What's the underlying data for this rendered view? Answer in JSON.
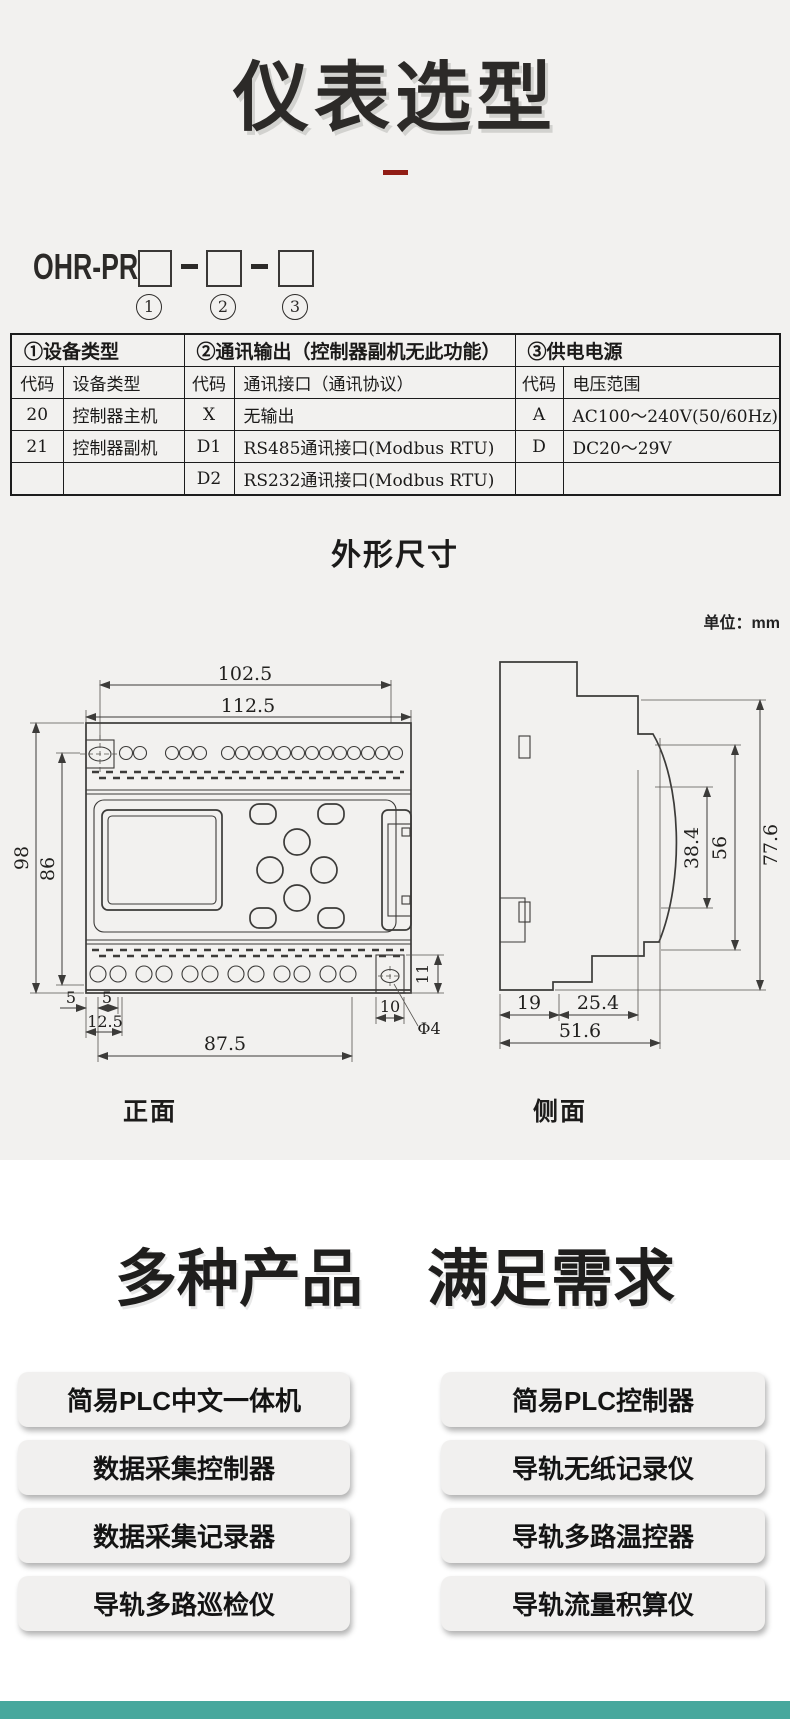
{
  "header": {
    "title": "仪表选型"
  },
  "model_code": {
    "prefix": "OHR-PR",
    "slot_labels": [
      "1",
      "2",
      "3"
    ]
  },
  "selection_table": {
    "section_headers": [
      "①设备类型",
      "②通讯输出（控制器副机无此功能）",
      "③供电电源"
    ],
    "column_headers": [
      "代码",
      "设备类型",
      "代码",
      "通讯接口（通讯协议）",
      "代码",
      "电压范围"
    ],
    "rows": [
      [
        "20",
        "控制器主机",
        "X",
        "无输出",
        "A",
        "AC100～240V(50/60Hz)"
      ],
      [
        "21",
        "控制器副机",
        "D1",
        "RS485通讯接口(Modbus RTU)",
        "D",
        "DC20～29V"
      ],
      [
        "",
        "",
        "D2",
        "RS232通讯接口(Modbus RTU)",
        "",
        ""
      ]
    ]
  },
  "outline": {
    "heading": "外形尺寸",
    "unit_label": "单位：mm",
    "front_view_label": "正面",
    "side_view_label": "侧面",
    "front_dims": {
      "width_inner": "102.5",
      "width_outer": "112.5",
      "height_outer": "98",
      "height_inner": "86",
      "left_margin": "5",
      "hole_pitch": "5",
      "offset": "12.5",
      "terminal_span": "87.5",
      "right_box_width": "10",
      "hole_dia": "Φ4",
      "right_box_height": "11"
    },
    "side_dims": {
      "depth_front": "38.4",
      "depth_mid": "56",
      "depth_total": "77.6",
      "base_left": "19",
      "base_mid": "25.4",
      "base_total": "51.6"
    }
  },
  "products": {
    "heading": [
      "多种产品",
      "满足需求"
    ],
    "left_column": [
      "简易PLC中文一体机",
      "数据采集控制器",
      "数据采集记录器",
      "导轨多路巡检仪"
    ],
    "right_column": [
      "简易PLC控制器",
      "导轨无纸记录仪",
      "导轨多路温控器",
      "导轨流量积算仪"
    ]
  },
  "theme": {
    "footer_color": "#47a89d",
    "accent_red": "#911d15"
  }
}
